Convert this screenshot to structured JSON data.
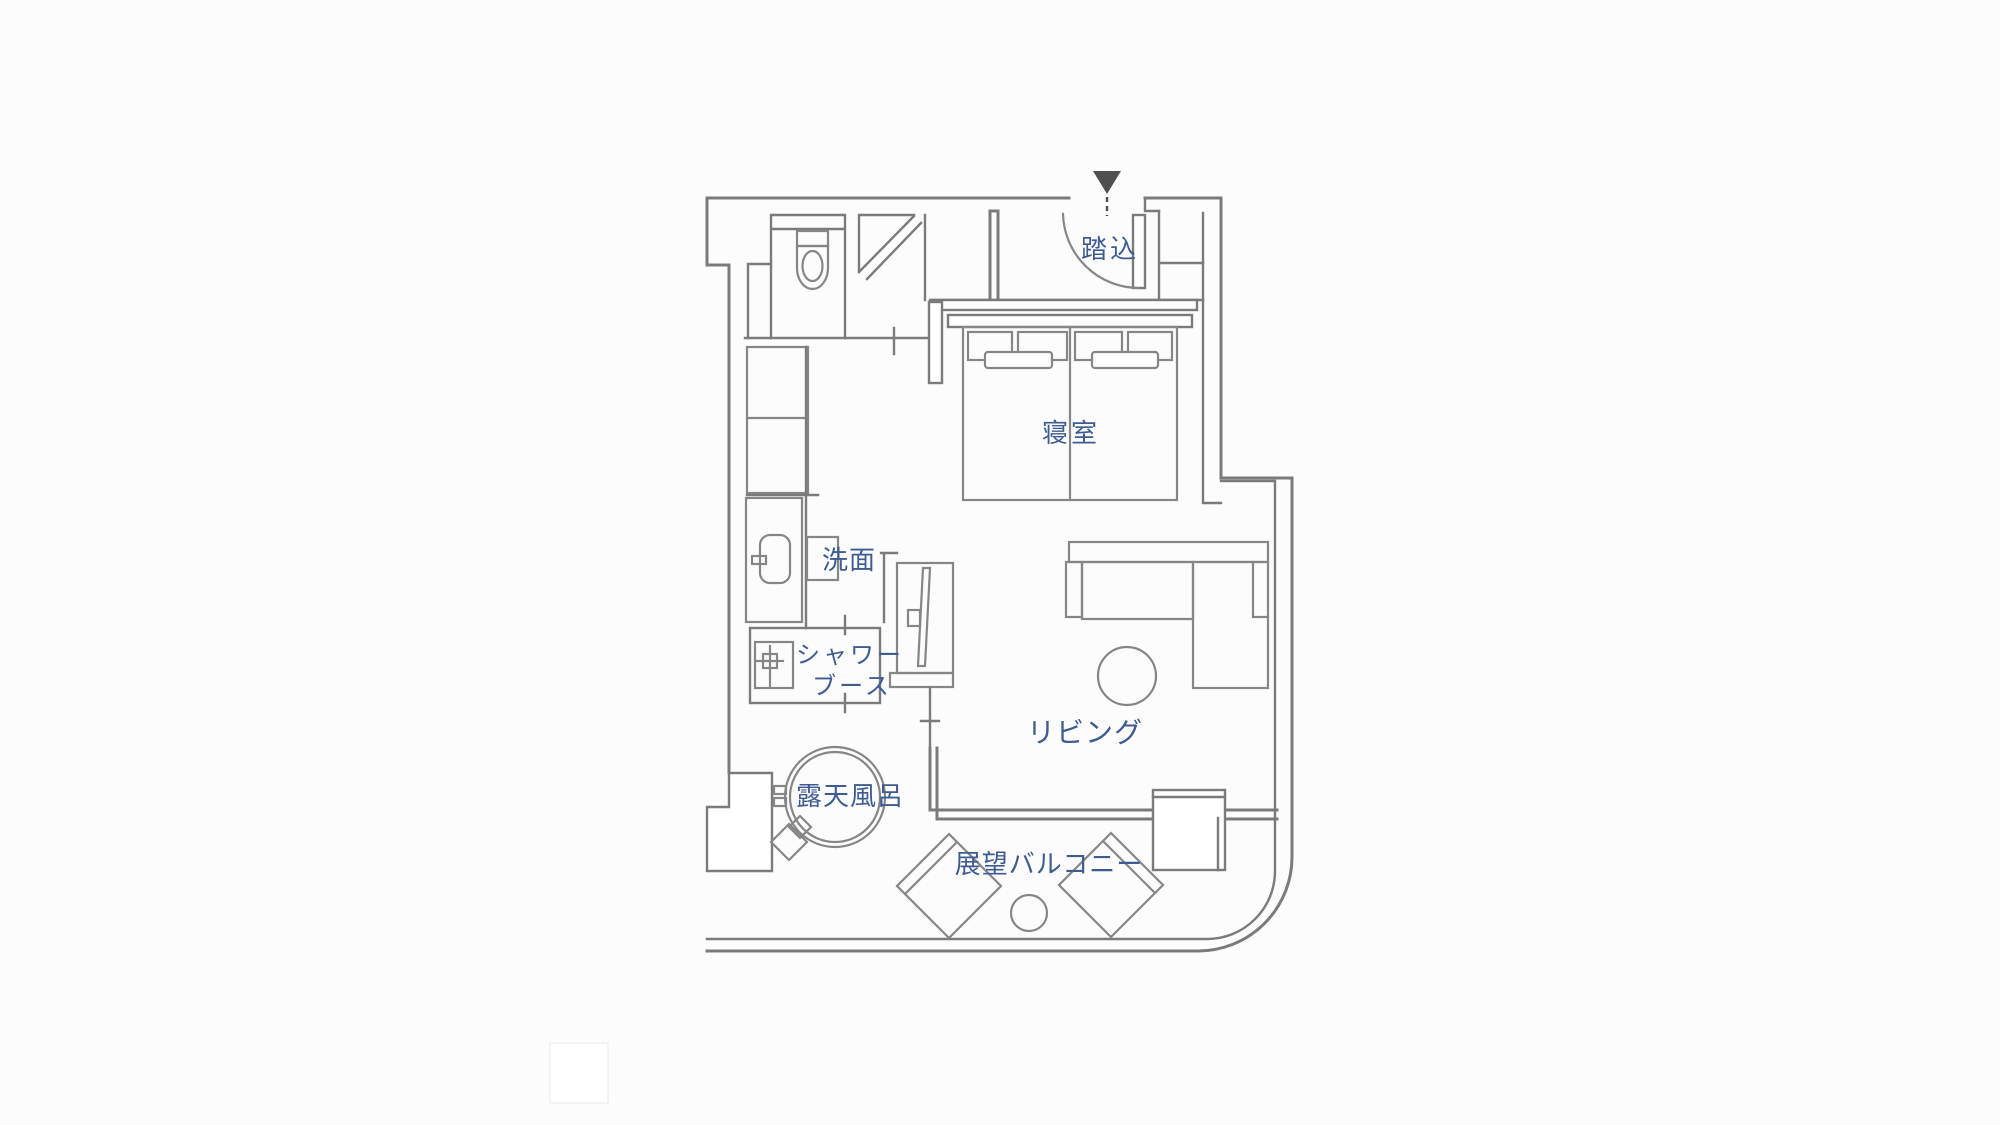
{
  "title": "room-floor-plan",
  "colors": {
    "wall": "#7b7b7b",
    "furniture": "#868686",
    "label": "#3e5c92",
    "arrow": "#4f4f4f",
    "background": "#fcfcfc"
  },
  "labels": {
    "entrance": "踏込",
    "bedroom": "寝室",
    "washroom": "洗面",
    "shower_line1": "シャワー",
    "shower_line2": "ブース",
    "open_air_bath": "露天風呂",
    "living": "リビング",
    "balcony": "展望バルコニー"
  },
  "icons": {
    "entry_arrow": "down-triangle"
  },
  "rooms": [
    {
      "name": "entrance",
      "label": "踏込"
    },
    {
      "name": "bedroom",
      "label": "寝室"
    },
    {
      "name": "washroom",
      "label": "洗面"
    },
    {
      "name": "shower-booth",
      "label": "シャワーブース"
    },
    {
      "name": "open-air-bath",
      "label": "露天風呂"
    },
    {
      "name": "living",
      "label": "リビング"
    },
    {
      "name": "view-balcony",
      "label": "展望バルコニー"
    }
  ]
}
